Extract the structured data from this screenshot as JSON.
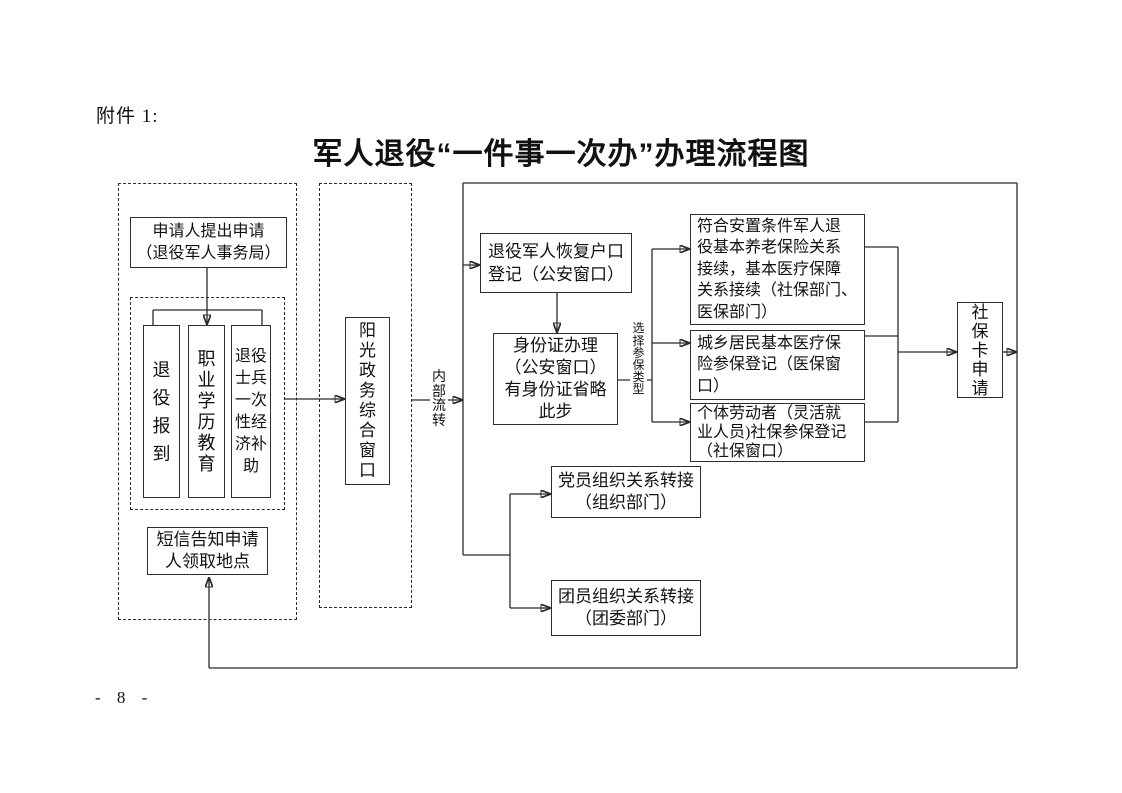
{
  "page": {
    "attachment_label": "附件 1:",
    "title": "军人退役“一件事一次办”办理流程图",
    "page_number": "- 8 -"
  },
  "nodes": {
    "applicant": "申请人提出申请\n（退役军人事务局）",
    "retire_checkin": "退\n役\n报\n到",
    "vocational_education": "职\n业\n学\n历\n教\n育",
    "onetime_subsidy": "退役\n士兵\n一次\n性经\n济补\n助",
    "sms_notify": "短信告知申请\n人领取地点",
    "sunshine_window": "阳\n光\n政\n务\n综\n合\n窗\n口",
    "hukou_restore": "退役军人恢复户口\n登记（公安窗口）",
    "id_card": "身份证办理\n（公安窗口）\n有身份证省略\n此步",
    "pension_medical_continue": "符合安置条件军人退\n役基本养老保险关系\n接续，基本医疗保障\n关系接续（社保部门、\n医保部门）",
    "resident_medical": "城乡居民基本医疗保\n险参保登记（医保窗\n口）",
    "individual_social": "个体劳动者（灵活就\n业人员)社保参保登记\n（社保窗口）",
    "social_card": "社\n保\n卡\n申\n请",
    "party_transfer": "党员组织关系转接\n（组织部门）",
    "league_transfer": "团员组织关系转接\n（团委部门）"
  },
  "labels": {
    "internal_flow": "内\n部\n流\n转",
    "select_insurance_type": "选\n择\n参\n保\n类\n型"
  }
}
